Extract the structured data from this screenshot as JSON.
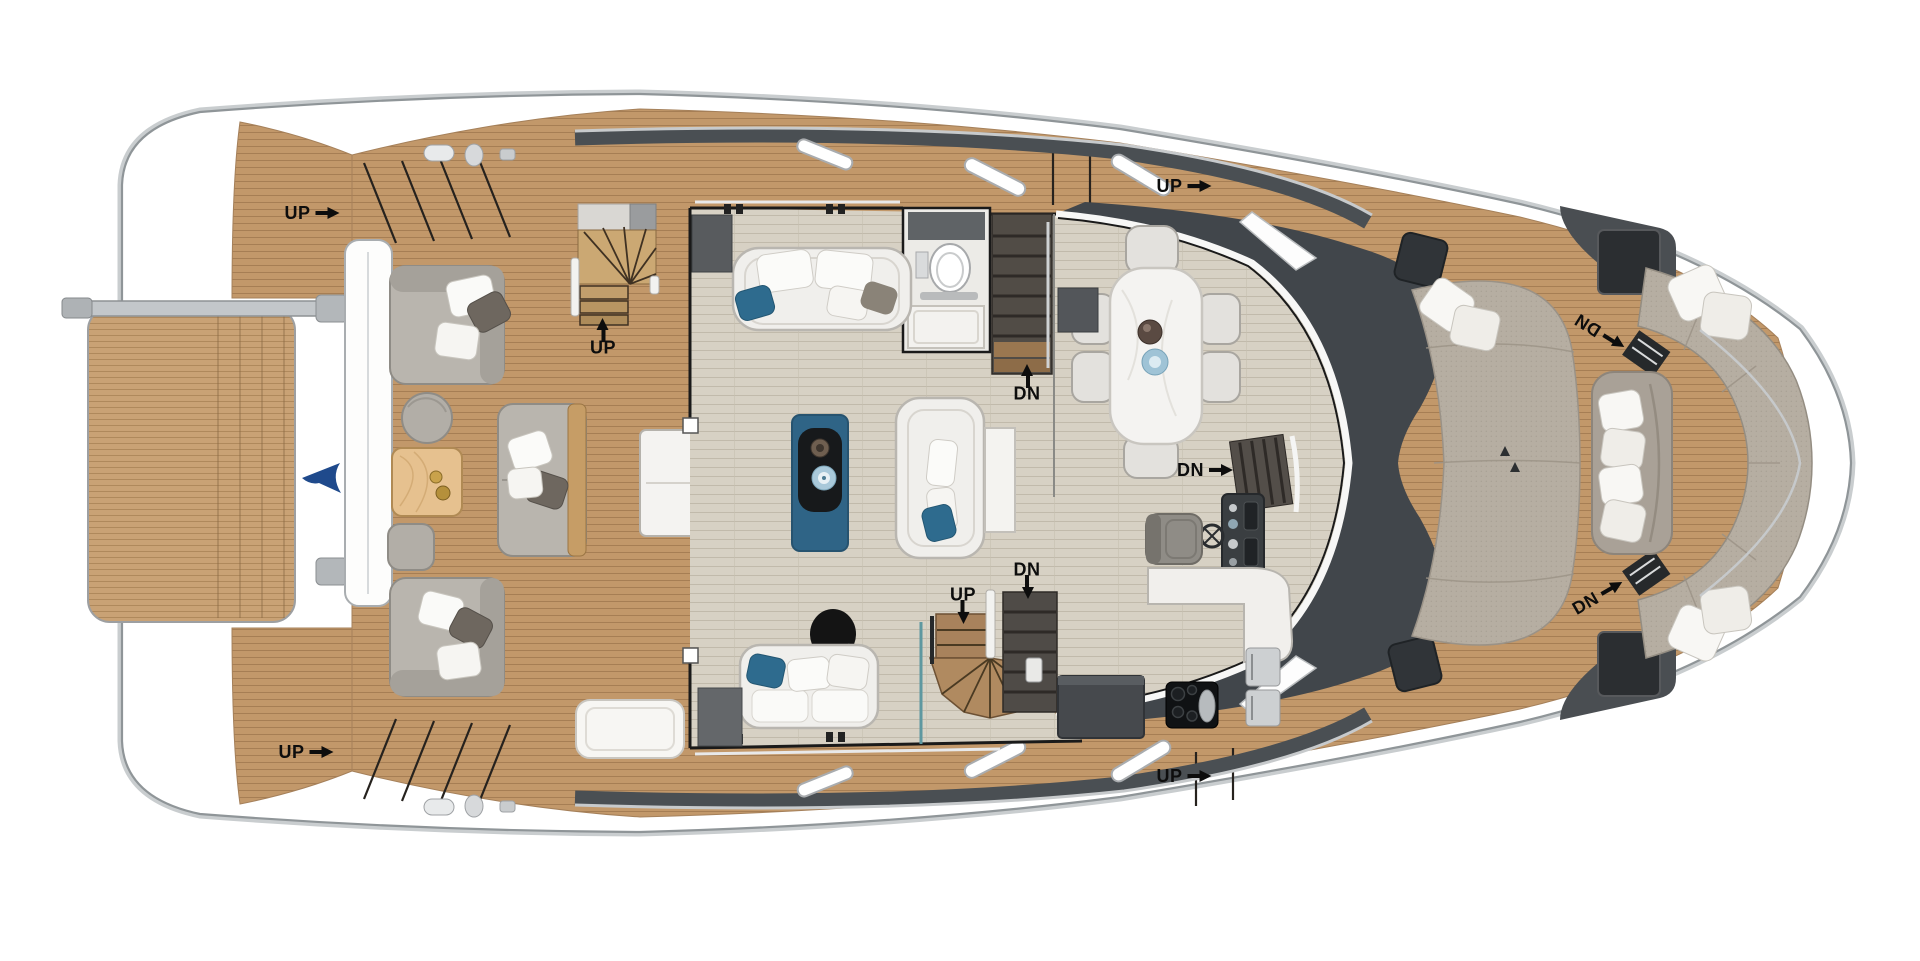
{
  "labels": [
    {
      "id": "up-aft-port-steps",
      "text": "UP",
      "arrow": "right"
    },
    {
      "id": "up-aft-spiral-stairs",
      "text": "UP",
      "arrow": "up"
    },
    {
      "id": "up-aft-starboard-steps",
      "text": "UP",
      "arrow": "right"
    },
    {
      "id": "up-side-deck-port",
      "text": "UP",
      "arrow": "right"
    },
    {
      "id": "up-side-deck-starboard",
      "text": "UP",
      "arrow": "right"
    },
    {
      "id": "up-salon-spiral-stairs",
      "text": "UP",
      "arrow": "down"
    },
    {
      "id": "dn-port-hull-stairs",
      "text": "DN",
      "arrow": "up"
    },
    {
      "id": "dn-starboard-hull-stairs",
      "text": "DN",
      "arrow": "down"
    },
    {
      "id": "dn-galley-stairs",
      "text": "DN",
      "arrow": "right"
    },
    {
      "id": "dn-bow-port-companionway",
      "text": "DN",
      "arrow": "angled-down-right"
    },
    {
      "id": "dn-bow-starboard-companionway",
      "text": "DN",
      "arrow": "angled-up-right"
    }
  ],
  "colors": {
    "teak_deck": "#c2986a",
    "swim_platform_teak": "#c9a275",
    "interior_floor": "#d7d1c4",
    "coffee_table_blue": "#2f6486",
    "pillow_blue": "#2e6b8e",
    "sunpad_fabric": "#b6aea2",
    "superstructure_dark": "#45494d",
    "stair_dark": "#514c46",
    "stair_wood": "#cba873",
    "flag_blue": "#1f4a8c",
    "label_text": "#0d0d0d",
    "hull_white": "#ffffff"
  }
}
